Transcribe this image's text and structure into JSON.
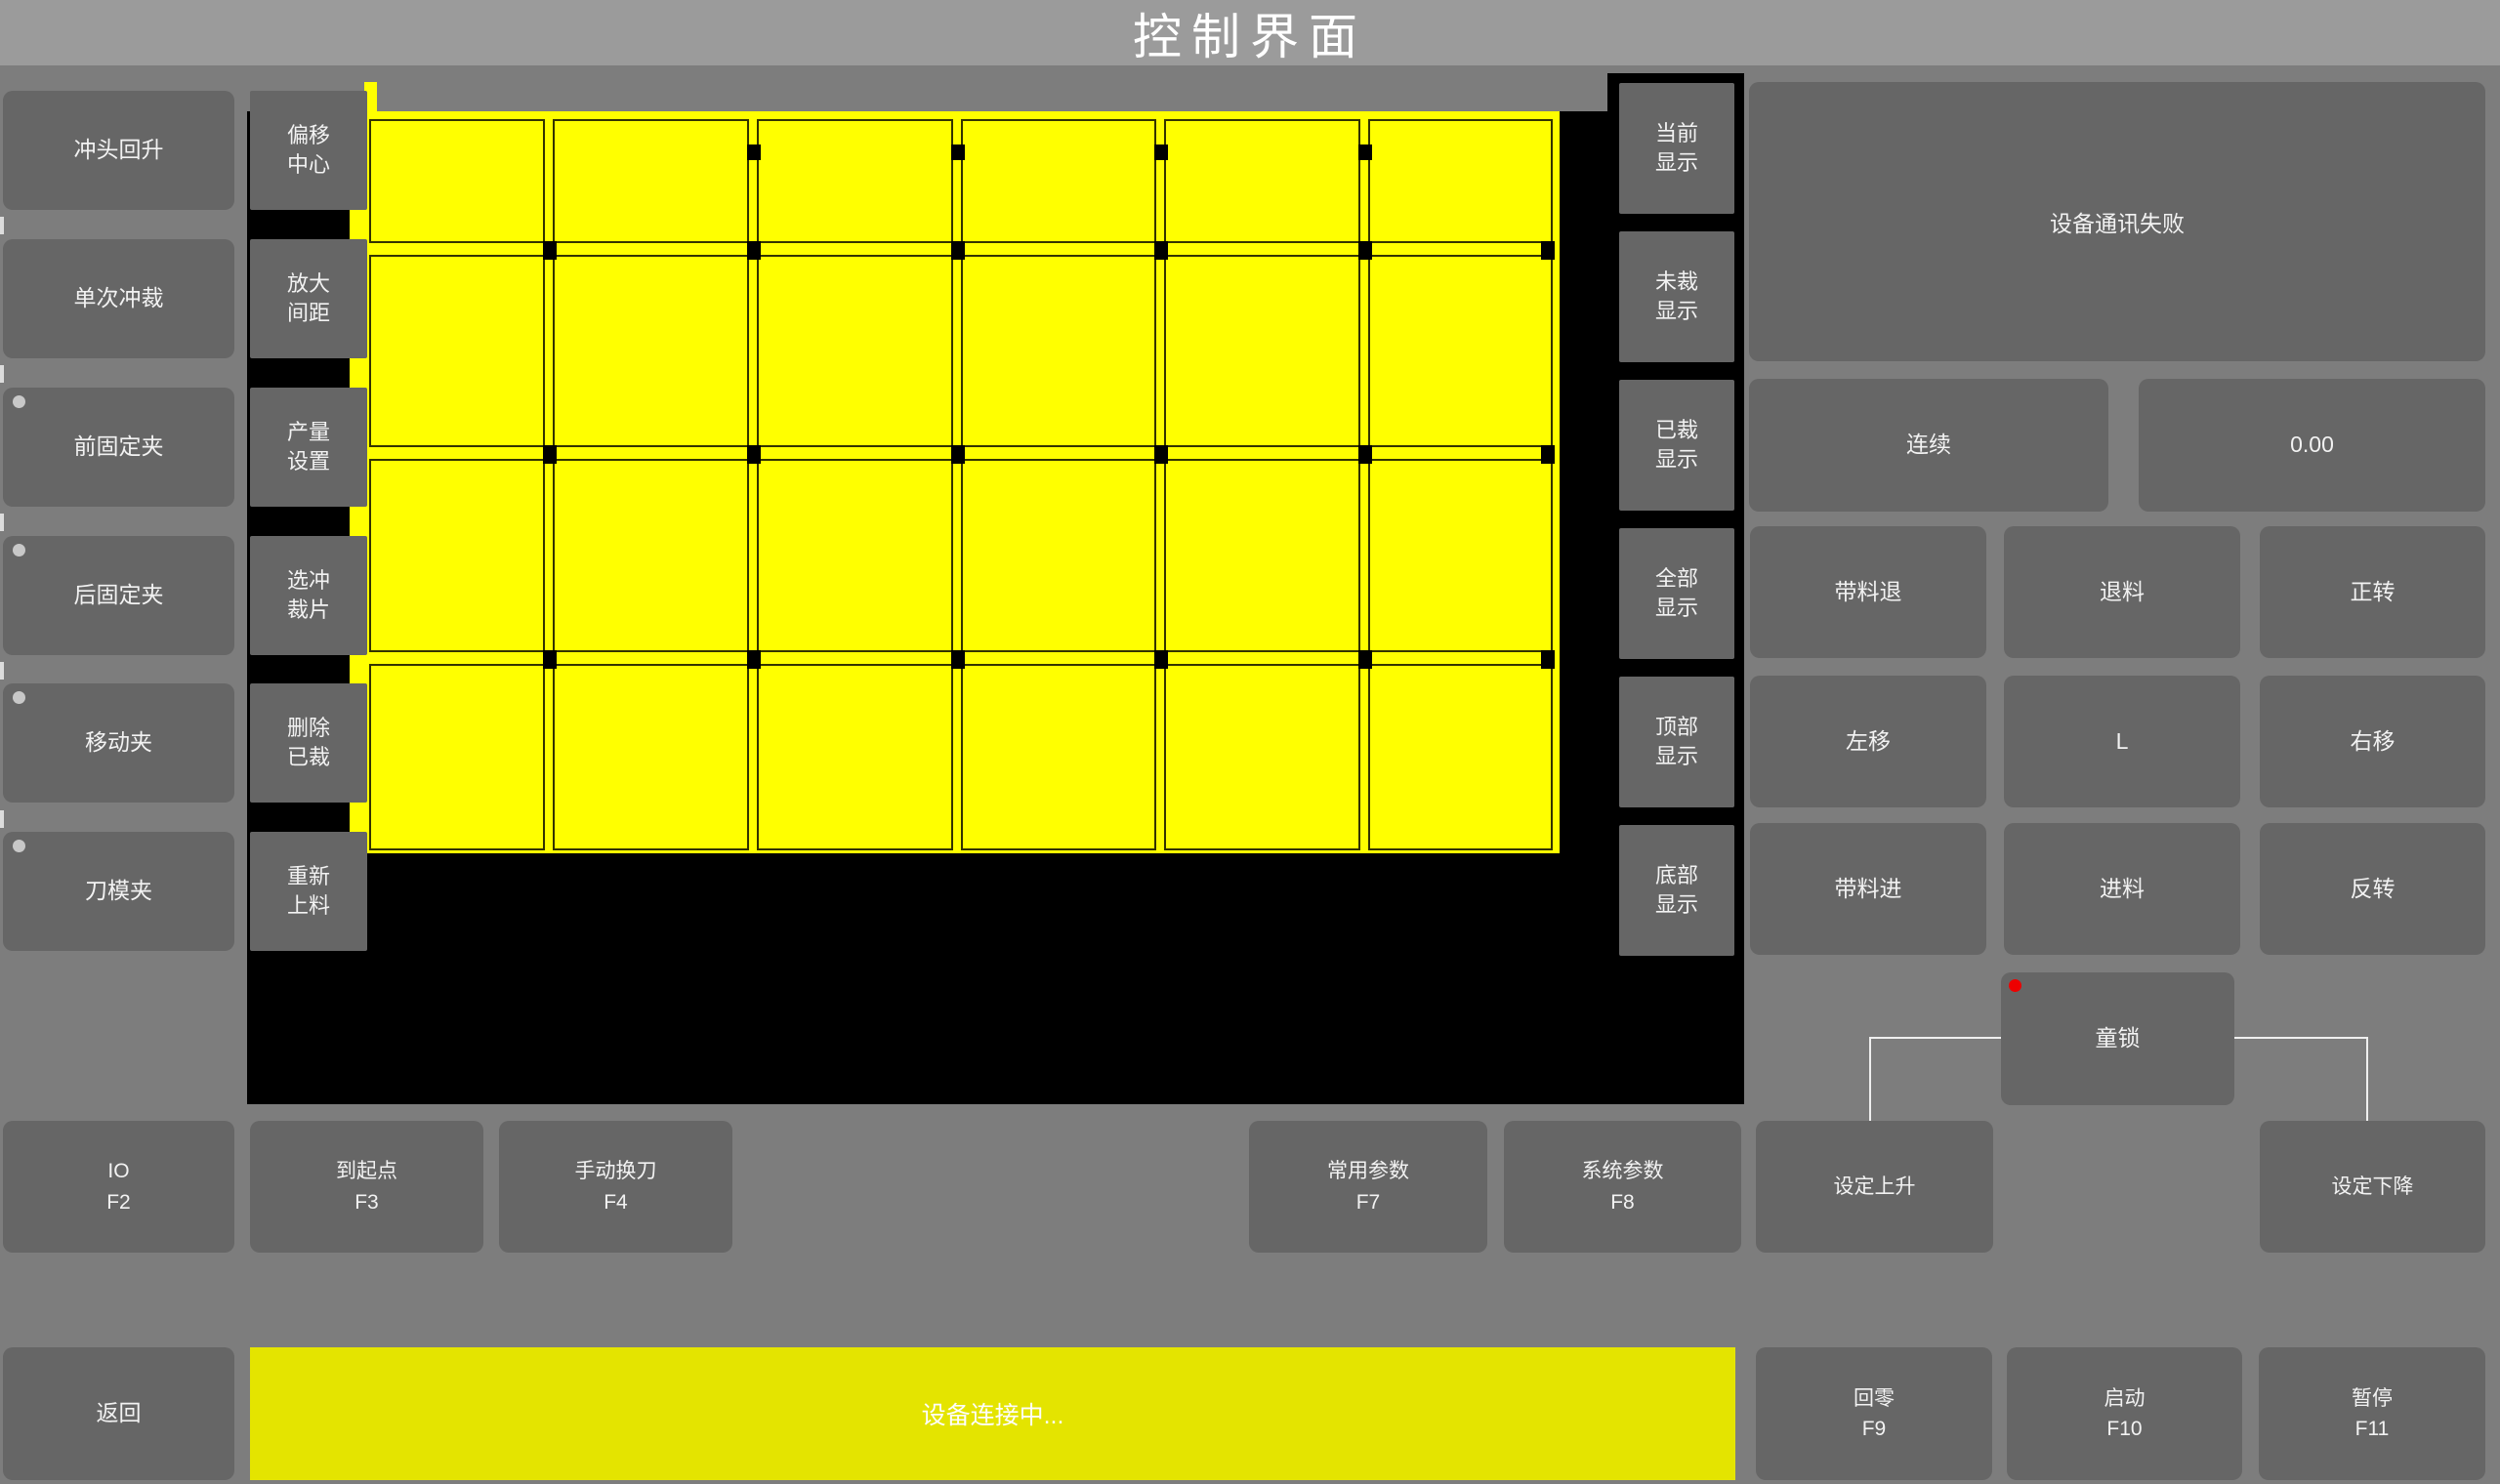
{
  "title": "控制界面",
  "left_buttons": [
    {
      "label": "冲头回升",
      "dot": false
    },
    {
      "label": "单次冲裁",
      "dot": false
    },
    {
      "label": "前固定夹",
      "dot": true
    },
    {
      "label": "后固定夹",
      "dot": true
    },
    {
      "label": "移动夹",
      "dot": true
    },
    {
      "label": "刀模夹",
      "dot": true
    }
  ],
  "mid_buttons": [
    "偏移\n中心",
    "放大\n间距",
    "产量\n设置",
    "选冲\n裁片",
    "删除\n已裁",
    "重新\n上料"
  ],
  "display_buttons": [
    "当前\n显示",
    "未裁\n显示",
    "已裁\n显示",
    "全部\n显示",
    "顶部\n显示",
    "底部\n显示"
  ],
  "status_panel": {
    "message": "设备通讯失败"
  },
  "mode_row": {
    "mode_label": "连续",
    "value": "0.00"
  },
  "motion_buttons": [
    "带料退",
    "退料",
    "正转",
    "左移",
    "L",
    "右移",
    "带料进",
    "进料",
    "反转"
  ],
  "child_lock": {
    "label": "童锁"
  },
  "function_keys": [
    {
      "label": "IO",
      "key": "F2"
    },
    {
      "label": "到起点",
      "key": "F3"
    },
    {
      "label": "手动换刀",
      "key": "F4"
    },
    {
      "label": "常用参数",
      "key": "F7"
    },
    {
      "label": "系统参数",
      "key": "F8"
    }
  ],
  "set_buttons": {
    "up": "设定上升",
    "down": "设定下降"
  },
  "bottom_bar": {
    "back": "返回",
    "status_message": "设备连接中...",
    "keys": [
      {
        "label": "回零",
        "key": "F9"
      },
      {
        "label": "启动",
        "key": "F10"
      },
      {
        "label": "暂停",
        "key": "F11"
      }
    ]
  },
  "sheet": {
    "columns": 6,
    "rows": 4
  },
  "colors": {
    "background": "#7d7d7d",
    "titlebar": "#9b9b9b",
    "button_gray": "#666666",
    "sheet_yellow": "#ffff00",
    "bar_yellow": "#e4e400",
    "alert_red": "#ee0000",
    "indicator_gray": "#c8c8c8"
  }
}
